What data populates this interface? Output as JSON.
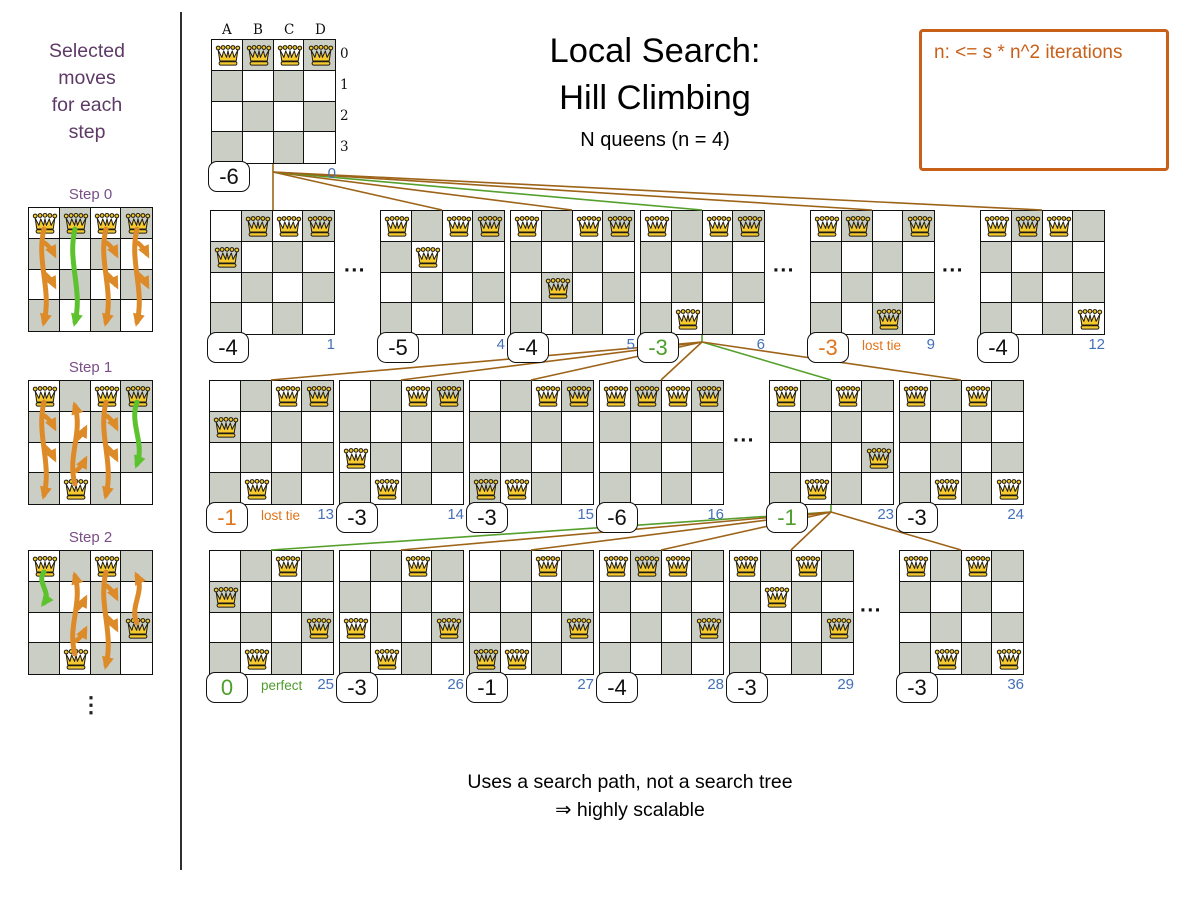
{
  "title": {
    "line1": "Local Search:",
    "line2": "Hill Climbing",
    "subtitle": "N queens (n = 4)"
  },
  "note_box": {
    "text": "n: <= s * n^2 iterations"
  },
  "footer": {
    "line1": "Uses a search path, not a search tree",
    "line2": "⇒ highly scalable"
  },
  "ellipsis_text": "...",
  "sidebar": {
    "heading_lines": [
      "Selected",
      "moves",
      "for each",
      "step"
    ],
    "ellipsis": "⋮",
    "steps": [
      {
        "label": "Step 0",
        "label_y": 186,
        "board_y": 207,
        "queens": [
          [
            0,
            0
          ],
          [
            1,
            0
          ],
          [
            2,
            0
          ],
          [
            3,
            0
          ]
        ],
        "arrows": [
          {
            "col": 0,
            "from": 0,
            "to": 3,
            "color": "orange"
          },
          {
            "col": 1,
            "from": 0,
            "to": 3,
            "color": "green"
          },
          {
            "col": 2,
            "from": 0,
            "to": 3,
            "color": "orange"
          },
          {
            "col": 3,
            "from": 0,
            "to": 3,
            "color": "orange"
          }
        ]
      },
      {
        "label": "Step 1",
        "label_y": 359,
        "board_y": 380,
        "queens": [
          [
            0,
            0
          ],
          [
            2,
            0
          ],
          [
            3,
            0
          ],
          [
            1,
            3
          ]
        ],
        "arrows": [
          {
            "col": 0,
            "from": 0,
            "to": 3,
            "color": "orange"
          },
          {
            "col": 1,
            "from": 3,
            "to": 0,
            "color": "orange"
          },
          {
            "col": 2,
            "from": 0,
            "to": 3,
            "color": "orange"
          },
          {
            "col": 3,
            "from": 0,
            "to": 2,
            "color": "green"
          }
        ]
      },
      {
        "label": "Step 2",
        "label_y": 529,
        "board_y": 550,
        "queens": [
          [
            0,
            0
          ],
          [
            2,
            0
          ],
          [
            3,
            2
          ],
          [
            1,
            3
          ]
        ],
        "arrows": [
          {
            "col": 0,
            "from": 0,
            "to": 1,
            "color": "green"
          },
          {
            "col": 1,
            "from": 3,
            "to": 0,
            "color": "orange"
          },
          {
            "col": 2,
            "from": 0,
            "to": 3,
            "color": "orange"
          },
          {
            "col": 3,
            "from": 2,
            "to": 0,
            "color": "orange"
          }
        ]
      }
    ]
  },
  "root": {
    "x": 211,
    "y": 39,
    "queens": [
      [
        0,
        0
      ],
      [
        1,
        0
      ],
      [
        2,
        0
      ],
      [
        3,
        0
      ]
    ],
    "score": "-6",
    "color": "black",
    "index": "0",
    "col_headers": [
      "A",
      "B",
      "C",
      "D"
    ],
    "row_headers": [
      "0",
      "1",
      "2",
      "3"
    ]
  },
  "tree": {
    "rows": [
      {
        "y": 210,
        "boards": [
          {
            "x": 210,
            "index": "1",
            "score": "-4",
            "color": "black",
            "queens": [
              [
                1,
                0
              ],
              [
                2,
                0
              ],
              [
                3,
                0
              ],
              [
                0,
                1
              ]
            ]
          },
          {
            "x": 380,
            "index": "4",
            "score": "-5",
            "color": "black",
            "queens": [
              [
                0,
                0
              ],
              [
                2,
                0
              ],
              [
                3,
                0
              ],
              [
                1,
                1
              ]
            ]
          },
          {
            "x": 510,
            "index": "5",
            "score": "-4",
            "color": "black",
            "queens": [
              [
                0,
                0
              ],
              [
                2,
                0
              ],
              [
                3,
                0
              ],
              [
                1,
                2
              ]
            ]
          },
          {
            "x": 640,
            "index": "6",
            "score": "-3",
            "color": "green",
            "queens": [
              [
                0,
                0
              ],
              [
                2,
                0
              ],
              [
                3,
                0
              ],
              [
                1,
                3
              ]
            ]
          },
          {
            "x": 810,
            "index": "9",
            "score": "-3",
            "color": "orange",
            "tag": "lost tie",
            "queens": [
              [
                0,
                0
              ],
              [
                1,
                0
              ],
              [
                3,
                0
              ],
              [
                2,
                3
              ]
            ]
          },
          {
            "x": 980,
            "index": "12",
            "score": "-4",
            "color": "black",
            "queens": [
              [
                0,
                0
              ],
              [
                1,
                0
              ],
              [
                2,
                0
              ],
              [
                3,
                3
              ]
            ]
          }
        ]
      },
      {
        "y": 380,
        "boards": [
          {
            "x": 209,
            "index": "13",
            "score": "-1",
            "color": "orange",
            "tag": "lost tie",
            "queens": [
              [
                2,
                0
              ],
              [
                3,
                0
              ],
              [
                0,
                1
              ],
              [
                1,
                3
              ]
            ]
          },
          {
            "x": 339,
            "index": "14",
            "score": "-3",
            "color": "black",
            "queens": [
              [
                2,
                0
              ],
              [
                3,
                0
              ],
              [
                0,
                2
              ],
              [
                1,
                3
              ]
            ]
          },
          {
            "x": 469,
            "index": "15",
            "score": "-3",
            "color": "black",
            "queens": [
              [
                2,
                0
              ],
              [
                3,
                0
              ],
              [
                0,
                3
              ],
              [
                1,
                3
              ]
            ]
          },
          {
            "x": 599,
            "index": "16",
            "score": "-6",
            "color": "black",
            "queens": [
              [
                0,
                0
              ],
              [
                1,
                0
              ],
              [
                2,
                0
              ],
              [
                3,
                0
              ]
            ]
          },
          {
            "x": 769,
            "index": "23",
            "score": "-1",
            "color": "green",
            "queens": [
              [
                0,
                0
              ],
              [
                2,
                0
              ],
              [
                3,
                2
              ],
              [
                1,
                3
              ]
            ]
          },
          {
            "x": 899,
            "index": "24",
            "score": "-3",
            "color": "black",
            "queens": [
              [
                0,
                0
              ],
              [
                2,
                0
              ],
              [
                1,
                3
              ],
              [
                3,
                3
              ]
            ]
          }
        ]
      },
      {
        "y": 550,
        "boards": [
          {
            "x": 209,
            "index": "25",
            "score": "0",
            "color": "green",
            "tag": "perfect",
            "queens": [
              [
                2,
                0
              ],
              [
                0,
                1
              ],
              [
                3,
                2
              ],
              [
                1,
                3
              ]
            ]
          },
          {
            "x": 339,
            "index": "26",
            "score": "-3",
            "color": "black",
            "queens": [
              [
                2,
                0
              ],
              [
                0,
                2
              ],
              [
                3,
                2
              ],
              [
                1,
                3
              ]
            ]
          },
          {
            "x": 469,
            "index": "27",
            "score": "-1",
            "color": "black",
            "queens": [
              [
                2,
                0
              ],
              [
                3,
                2
              ],
              [
                0,
                3
              ],
              [
                1,
                3
              ]
            ]
          },
          {
            "x": 599,
            "index": "28",
            "score": "-4",
            "color": "black",
            "queens": [
              [
                0,
                0
              ],
              [
                1,
                0
              ],
              [
                2,
                0
              ],
              [
                3,
                2
              ]
            ]
          },
          {
            "x": 729,
            "index": "29",
            "score": "-3",
            "color": "black",
            "queens": [
              [
                0,
                0
              ],
              [
                2,
                0
              ],
              [
                1,
                1
              ],
              [
                3,
                2
              ]
            ]
          },
          {
            "x": 899,
            "index": "36",
            "score": "-3",
            "color": "black",
            "queens": [
              [
                0,
                0
              ],
              [
                2,
                0
              ],
              [
                1,
                3
              ],
              [
                3,
                3
              ]
            ]
          }
        ]
      }
    ]
  },
  "ellipses": [
    {
      "x": 355,
      "y": 268
    },
    {
      "x": 784,
      "y": 268
    },
    {
      "x": 953,
      "y": 268
    },
    {
      "x": 744,
      "y": 438
    },
    {
      "x": 871,
      "y": 608
    }
  ],
  "connectors": [
    {
      "x1": 273,
      "y1": 164,
      "x2": 273,
      "y2": 210,
      "color": "brown"
    },
    {
      "x1": 273,
      "y1": 172,
      "x2": 442,
      "y2": 210,
      "color": "brown"
    },
    {
      "x1": 273,
      "y1": 172,
      "x2": 572,
      "y2": 210,
      "color": "brown"
    },
    {
      "x1": 273,
      "y1": 172,
      "x2": 702,
      "y2": 210,
      "color": "green"
    },
    {
      "x1": 273,
      "y1": 172,
      "x2": 872,
      "y2": 210,
      "color": "brown"
    },
    {
      "x1": 273,
      "y1": 172,
      "x2": 1042,
      "y2": 210,
      "color": "brown"
    },
    {
      "x1": 702,
      "y1": 335,
      "x2": 702,
      "y2": 342,
      "color": "green"
    },
    {
      "x1": 702,
      "y1": 342,
      "x2": 271,
      "y2": 380,
      "color": "brown"
    },
    {
      "x1": 702,
      "y1": 342,
      "x2": 401,
      "y2": 380,
      "color": "brown"
    },
    {
      "x1": 702,
      "y1": 342,
      "x2": 531,
      "y2": 380,
      "color": "brown"
    },
    {
      "x1": 702,
      "y1": 342,
      "x2": 661,
      "y2": 380,
      "color": "brown"
    },
    {
      "x1": 702,
      "y1": 342,
      "x2": 831,
      "y2": 380,
      "color": "green"
    },
    {
      "x1": 702,
      "y1": 342,
      "x2": 961,
      "y2": 380,
      "color": "brown"
    },
    {
      "x1": 831,
      "y1": 505,
      "x2": 831,
      "y2": 512,
      "color": "green"
    },
    {
      "x1": 831,
      "y1": 512,
      "x2": 271,
      "y2": 550,
      "color": "green"
    },
    {
      "x1": 831,
      "y1": 512,
      "x2": 401,
      "y2": 550,
      "color": "brown"
    },
    {
      "x1": 831,
      "y1": 512,
      "x2": 531,
      "y2": 550,
      "color": "brown"
    },
    {
      "x1": 831,
      "y1": 512,
      "x2": 661,
      "y2": 550,
      "color": "brown"
    },
    {
      "x1": 831,
      "y1": 512,
      "x2": 791,
      "y2": 550,
      "color": "brown"
    },
    {
      "x1": 831,
      "y1": 512,
      "x2": 961,
      "y2": 550,
      "color": "brown"
    }
  ],
  "colors": {
    "brown": "#9d6419",
    "green_line": "#55a02c",
    "score_green": "#4f9d2d",
    "score_orange": "#e0751c",
    "index_blue": "#4470b8",
    "purple_heading": "#5e3a66",
    "purple_step": "#7a4f87",
    "note_orange": "#c8601a",
    "cell_gray": "#cbcec5",
    "arrow_orange": "#dd8a28",
    "arrow_green": "#5cc22d",
    "queen_gold": "#f6ca2f"
  }
}
